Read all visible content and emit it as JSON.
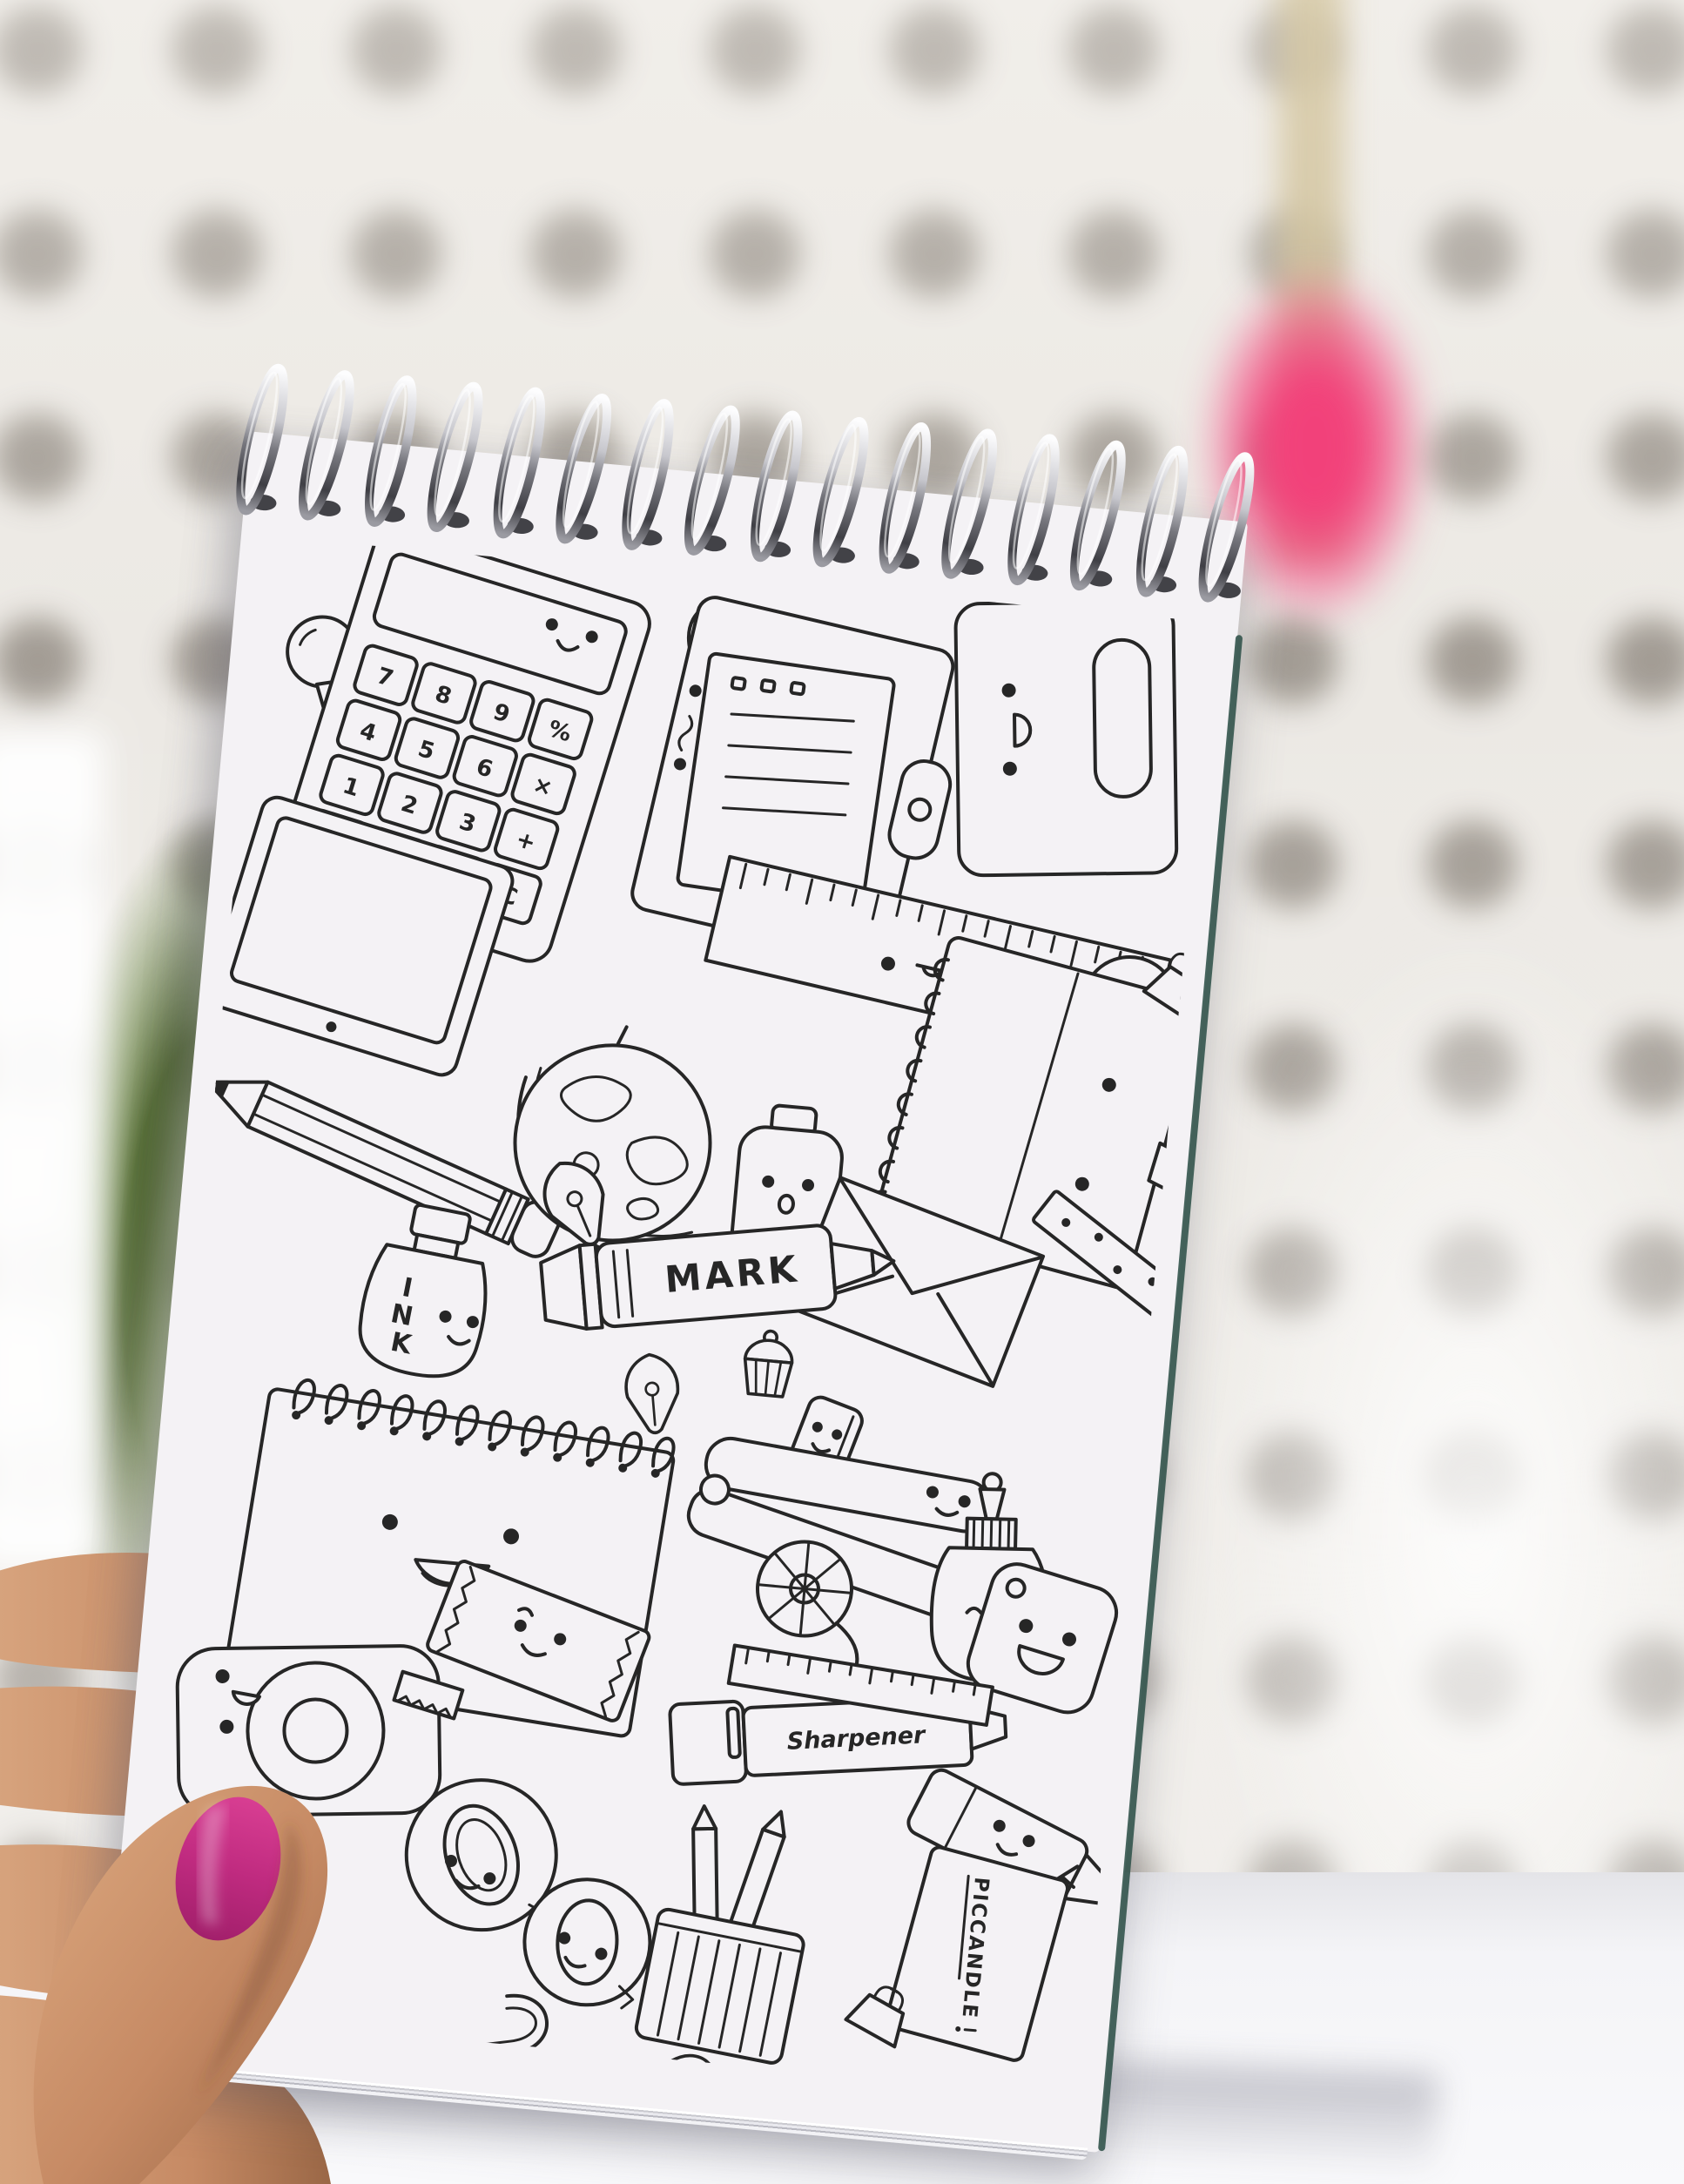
{
  "scene": {
    "type": "photograph",
    "subject": "hand holding spiral notepad with kawaii stationery doodle coloring page",
    "colors": {
      "wall_base": "#ECE9E4",
      "wall_dots": "#8F887E",
      "desk": "#F9F9FB",
      "desk_shadow": "#B9B9C2",
      "pom_pom_pink": "#F2417A",
      "stem_beige": "#D8CBA8",
      "leaves_green": "#5E7F33",
      "paper_white": "#F4F2F5",
      "line_ink": "#262626",
      "spiral_wire_light": "#FDFDFE",
      "spiral_wire_dark": "#3F3F45",
      "pad_edge_teal": "#33544C",
      "skin": "#C68A64",
      "skin_shadow": "#9A6746",
      "nail_polish": "#C02B80"
    },
    "notebook": {
      "spiral": {
        "loop_count": 16
      }
    }
  },
  "doodle": {
    "calculator": {
      "keys": [
        "7",
        "8",
        "9",
        "%",
        "4",
        "5",
        "6",
        "×",
        "1",
        "2",
        "3",
        "+",
        "0",
        ".",
        "=",
        "C"
      ]
    },
    "ink_letters": [
      "I",
      "N",
      "K"
    ],
    "marker_label": "MARK",
    "sharpener_label": "Sharpener",
    "artist_tag": "PICCANDLE",
    "items": [
      "pushpin",
      "calculator",
      "paper-clips",
      "clipboard",
      "phone-tag",
      "ruler",
      "pen-character",
      "tablet",
      "pencil",
      "globe",
      "ink-bottle",
      "spiral-notebook",
      "binder-clip",
      "bulldog-clip",
      "dotted-pencil",
      "bottle-character",
      "envelope",
      "fountain-pen-nib",
      "marker",
      "pen-cap-character",
      "cupcake",
      "spiral-notepad",
      "stapler",
      "rotary-cutter",
      "glue-bottle",
      "smiley-tag",
      "tape-dispenser",
      "eraser",
      "washi-tape-roll",
      "sharpener-marker",
      "mini-ruler",
      "pencil-cup",
      "highlighter",
      "artist-name-tag",
      "small-binder-clip"
    ]
  }
}
